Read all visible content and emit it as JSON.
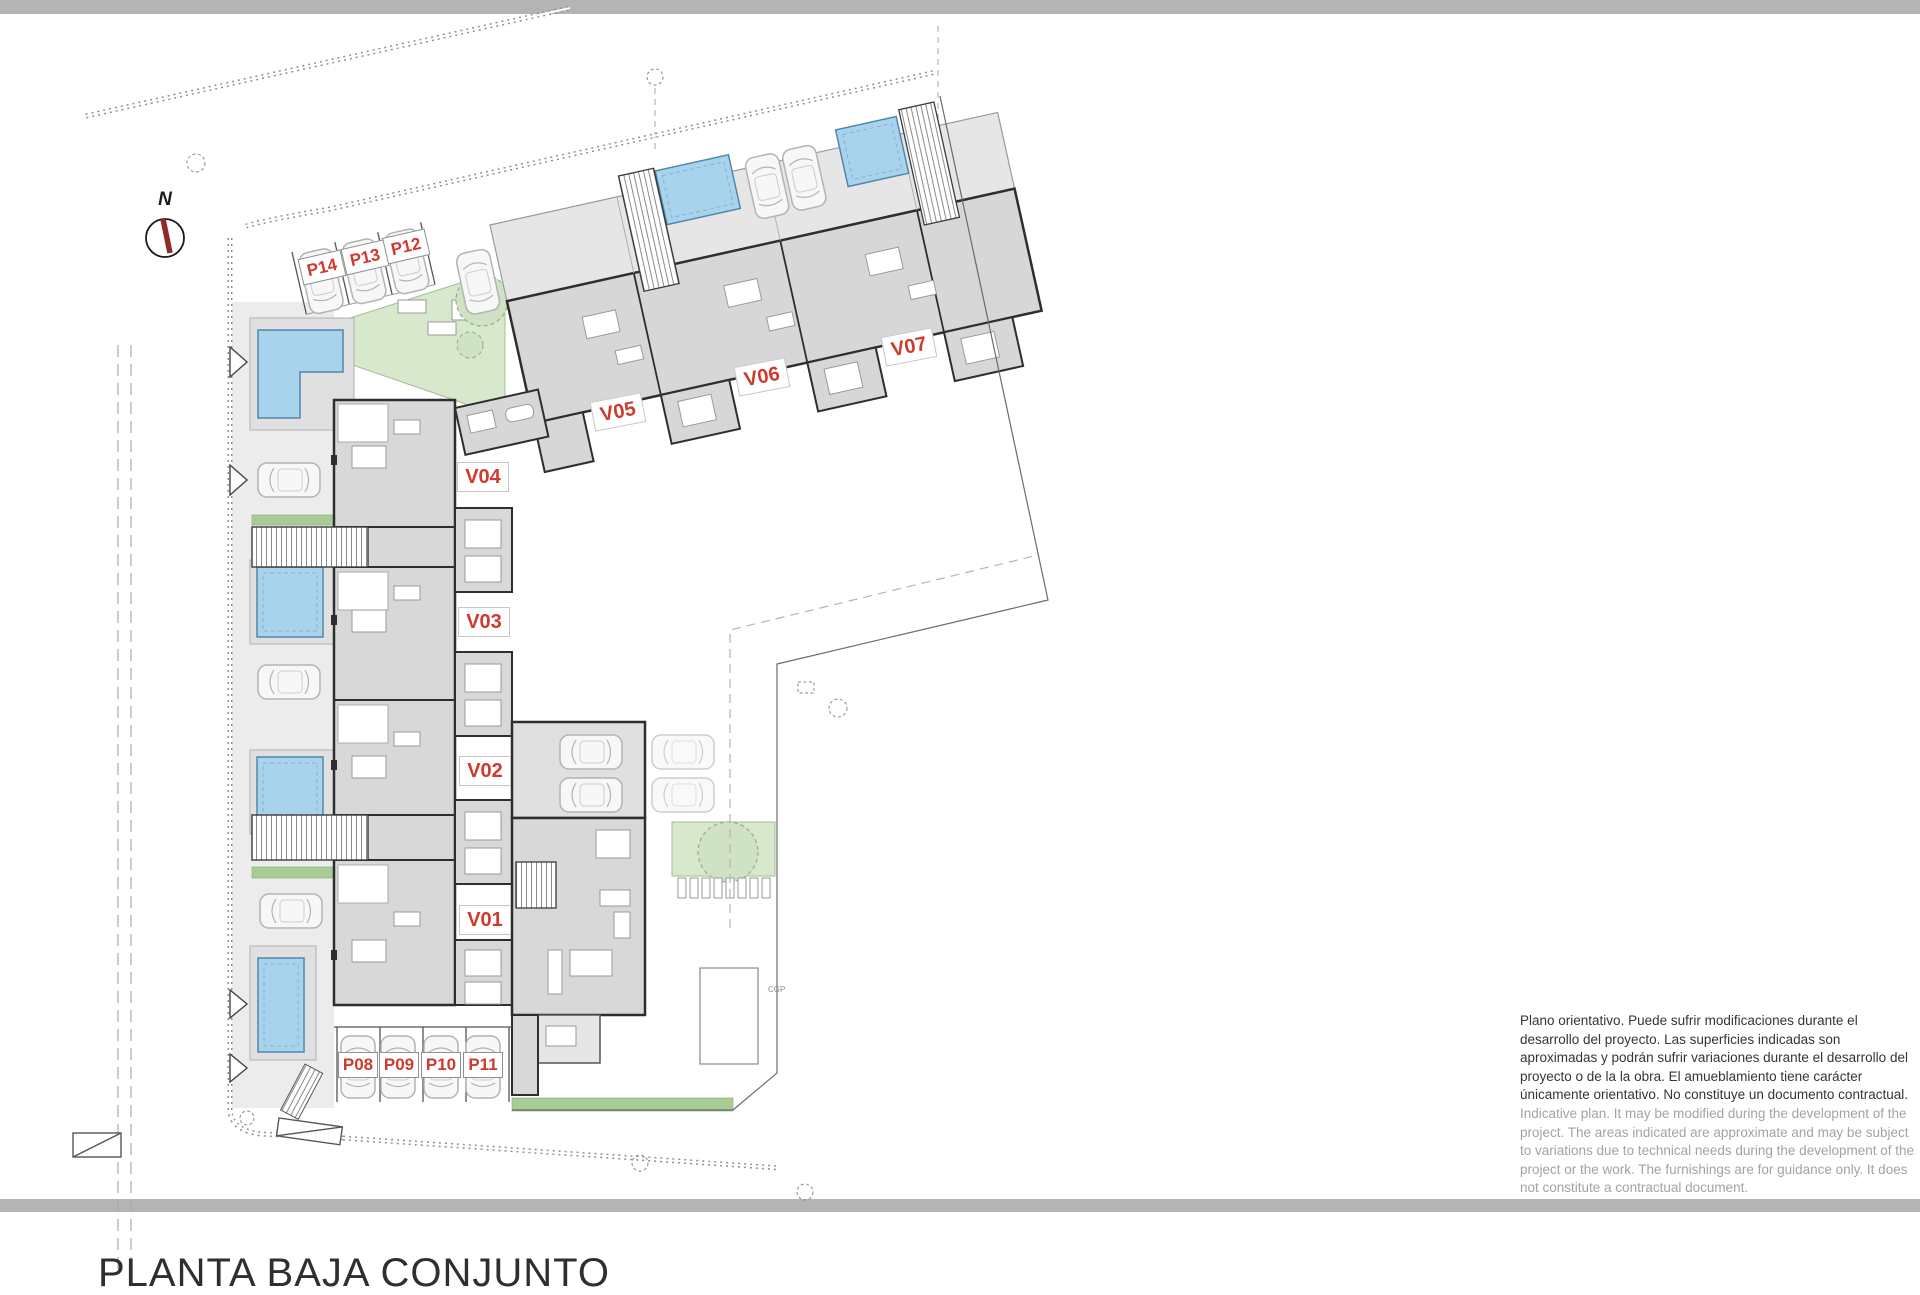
{
  "meta": {
    "title": "PLANTA BAJA CONJUNTO",
    "drawing_type": "architectural site plan, ground floor"
  },
  "compass": {
    "north_label": "N"
  },
  "labels": {
    "units": [
      {
        "id": "v01",
        "text": "V01"
      },
      {
        "id": "v02",
        "text": "V02"
      },
      {
        "id": "v03",
        "text": "V03"
      },
      {
        "id": "v04",
        "text": "V04"
      },
      {
        "id": "v05",
        "text": "V05"
      },
      {
        "id": "v06",
        "text": "V06"
      },
      {
        "id": "v07",
        "text": "V07"
      }
    ],
    "parking": [
      {
        "id": "p08",
        "text": "P08"
      },
      {
        "id": "p09",
        "text": "P09"
      },
      {
        "id": "p10",
        "text": "P10"
      },
      {
        "id": "p11",
        "text": "P11"
      },
      {
        "id": "p12",
        "text": "P12"
      },
      {
        "id": "p13",
        "text": "P13"
      },
      {
        "id": "p14",
        "text": "P14"
      }
    ]
  },
  "annotations": {
    "cgp": "CGP"
  },
  "disclaimer": {
    "es": "Plano orientativo. Puede sufrir modificaciones durante el desarrollo del proyecto. Las superficies indicadas son aproximadas y podrán sufrir variaciones durante el desarrollo del proyecto o de la la obra. El amueblamiento tiene carácter únicamente orientativo. No constituye un documento contractual.",
    "en": "Indicative plan. It may be modified during the development of the project. The areas indicated are approximate and may be subject to variations due to technical needs during the development of the project or the work. The furnishings are for guidance only. It does not constitute a contractual document."
  },
  "palette": {
    "accent_red": "#cf3a2c",
    "pool_blue": "#a9d3ec",
    "pool_edge": "#4f88ad",
    "building_gray": "#d8d8d8",
    "terrace_gray": "#e6e6e6",
    "wall_dark": "#2e2e2e",
    "garden_green": "#d8e8cd",
    "strip_green": "#a9cc96",
    "bar_gray": "#b4b4b4",
    "text_dark": "#353535",
    "text_muted": "#a3a3a3"
  }
}
